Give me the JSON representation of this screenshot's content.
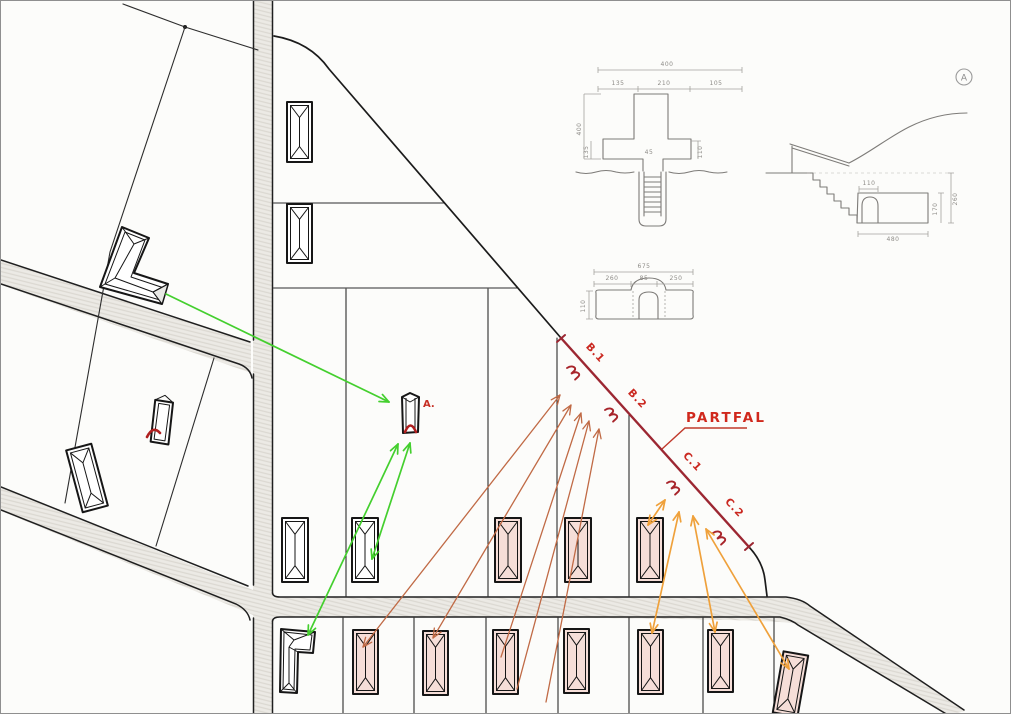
{
  "colors": {
    "paper": "#fcfcfa",
    "pencil": "#7d7b78",
    "ink": "#1f1f1f",
    "red_line": "#9c2732",
    "red_label": "#ca2820",
    "green": "#44cf2e",
    "brown": "#c06a45",
    "orange": "#efa13b",
    "building_pink": "#f6ded8",
    "road_fill": "#eceae5"
  },
  "map": {
    "labels": {
      "building_a": "A.",
      "partfal": "PARTFAL",
      "marker_b1": "B.1",
      "marker_b2": "B.2",
      "marker_c1": "C.1",
      "marker_c2": "C.2"
    },
    "buildings": [
      {
        "x": 286,
        "y": 101,
        "w": 25,
        "h": 60,
        "r": 0,
        "f": "#ffffff"
      },
      {
        "x": 286,
        "y": 203,
        "w": 25,
        "h": 59,
        "r": 0,
        "f": "#ffffff"
      },
      {
        "x": 281,
        "y": 517,
        "w": 26,
        "h": 64,
        "r": 0,
        "f": "#ffffff"
      },
      {
        "x": 351,
        "y": 517,
        "w": 26,
        "h": 64,
        "r": 0,
        "f": "#ffffff"
      },
      {
        "x": 494,
        "y": 517,
        "w": 26,
        "h": 64,
        "r": 0,
        "f": "#f6ded8"
      },
      {
        "x": 564,
        "y": 517,
        "w": 26,
        "h": 64,
        "r": 0,
        "f": "#f6ded8"
      },
      {
        "x": 636,
        "y": 517,
        "w": 26,
        "h": 64,
        "r": 0,
        "f": "#f6ded8"
      },
      {
        "x": 352,
        "y": 629,
        "w": 25,
        "h": 64,
        "r": 0,
        "f": "#f6ded8"
      },
      {
        "x": 422,
        "y": 630,
        "w": 25,
        "h": 64,
        "r": 0,
        "f": "#f6ded8"
      },
      {
        "x": 492,
        "y": 629,
        "w": 25,
        "h": 64,
        "r": 0,
        "f": "#f6ded8"
      },
      {
        "x": 563,
        "y": 628,
        "w": 25,
        "h": 64,
        "r": 0,
        "f": "#f6ded8"
      },
      {
        "x": 637,
        "y": 629,
        "w": 25,
        "h": 64,
        "r": 0,
        "f": "#f6ded8"
      },
      {
        "x": 707,
        "y": 629,
        "w": 25,
        "h": 62,
        "r": 0,
        "f": "#f6ded8"
      },
      {
        "x": 777,
        "y": 652,
        "w": 25,
        "h": 62,
        "r": 10,
        "f": "#f6ded8"
      },
      {
        "x": 73,
        "y": 445,
        "w": 26,
        "h": 64,
        "r": -15,
        "f": "#ffffff"
      }
    ],
    "arrows": [
      {
        "color": "green",
        "x1": 165,
        "y1": 293,
        "x2": 388,
        "y2": 401,
        "heads": "end"
      },
      {
        "color": "green",
        "x1": 307,
        "y1": 634,
        "x2": 397,
        "y2": 443,
        "heads": "both"
      },
      {
        "color": "green",
        "x1": 371,
        "y1": 558,
        "x2": 409,
        "y2": 442,
        "heads": "both"
      },
      {
        "color": "brown",
        "x1": 362,
        "y1": 646,
        "x2": 559,
        "y2": 394,
        "heads": "both"
      },
      {
        "color": "brown",
        "x1": 432,
        "y1": 637,
        "x2": 570,
        "y2": 404,
        "heads": "both"
      },
      {
        "color": "brown",
        "x1": 500,
        "y1": 656,
        "x2": 580,
        "y2": 412,
        "heads": "end"
      },
      {
        "color": "brown",
        "x1": 516,
        "y1": 688,
        "x2": 588,
        "y2": 420,
        "heads": "end"
      },
      {
        "color": "brown",
        "x1": 545,
        "y1": 701,
        "x2": 598,
        "y2": 428,
        "heads": "end"
      },
      {
        "color": "orange",
        "x1": 647,
        "y1": 524,
        "x2": 664,
        "y2": 499,
        "heads": "both"
      },
      {
        "color": "orange",
        "x1": 651,
        "y1": 632,
        "x2": 678,
        "y2": 511,
        "heads": "both"
      },
      {
        "color": "orange",
        "x1": 714,
        "y1": 631,
        "x2": 692,
        "y2": 515,
        "heads": "both"
      },
      {
        "color": "orange",
        "x1": 788,
        "y1": 668,
        "x2": 705,
        "y2": 528,
        "heads": "both"
      }
    ]
  },
  "technical_drawings": {
    "plan_view": {
      "width_total": "400",
      "width_left": "135",
      "width_mid": "210",
      "width_right": "105",
      "height_total": "400",
      "height_lower": "135",
      "height_right": "110",
      "angle_note": "45"
    },
    "facade": {
      "width_total": "675",
      "width_left": "260",
      "width_mid": "85",
      "width_right": "250",
      "height_left": "110"
    },
    "section": {
      "height_outer": "260",
      "height_inner": "170",
      "width_bottom": "480",
      "width_arch": "110"
    },
    "sheet_marker": "A"
  }
}
